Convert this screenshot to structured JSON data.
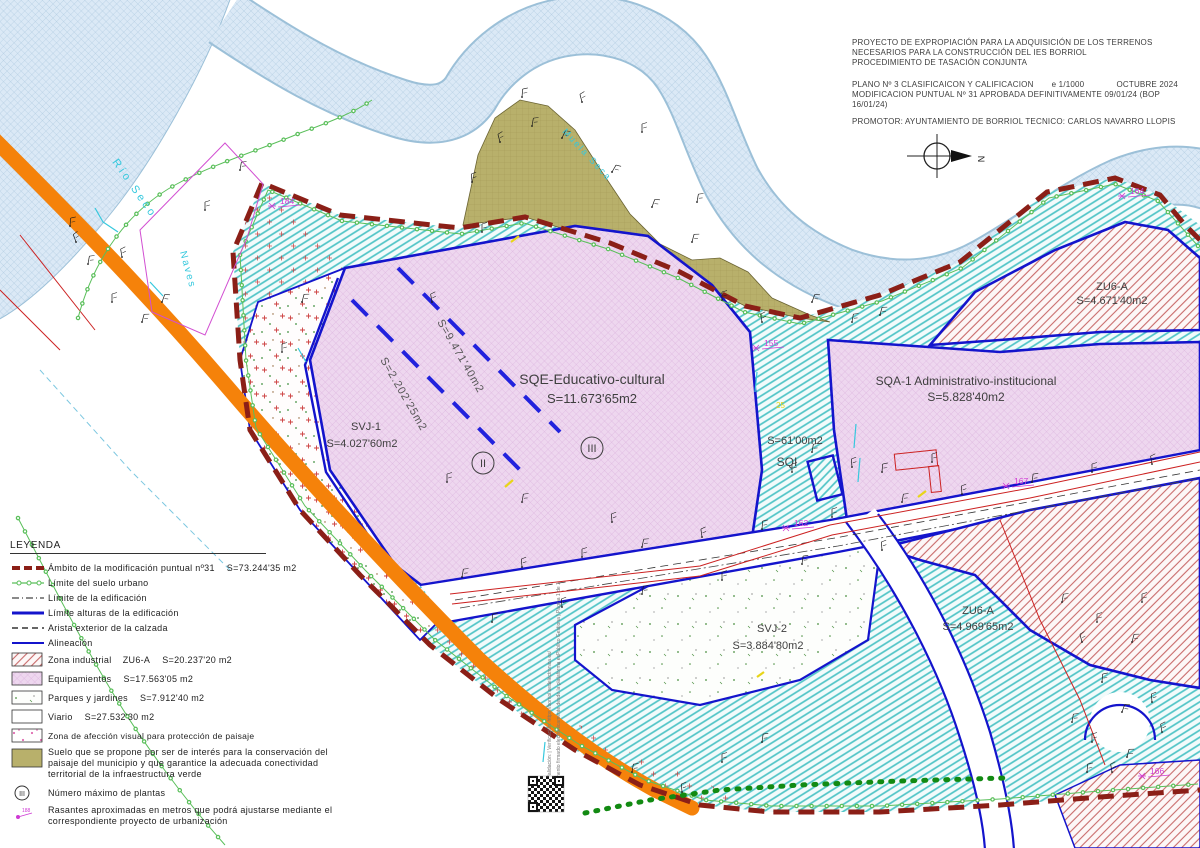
{
  "title_block": {
    "line1": "PROYECTO DE EXPROPIACIÓN PARA LA ADQUISICIÓN DE LOS TERRENOS",
    "line2": "NECESARIOS PARA LA CONSTRUCCIÓN DEL IES BORRIOL",
    "line3": "PROCEDIMIENTO DE TASACIÓN CONJUNTA",
    "plan": "PLANO Nº 3 CLASIFICAICON Y CALIFICACION",
    "scale": "e 1/1000",
    "date": "OCTUBRE 2024",
    "modification": "MODIFICACION PUNTUAL Nº 31 APROBADA DEFINITIVAMENTE 09/01/24 (BOP 16/01/24)",
    "promoter": "PROMOTOR: AYUNTAMIENTO DE BORRIOL  TECNICO: CARLOS NAVARRO LLOPIS"
  },
  "north_label": "N",
  "legend": {
    "title": "LEYENDA",
    "plantas_icon_text": "III",
    "rasantes_icon_text": "188",
    "items": [
      {
        "label": "Ámbito de la modificación puntual nº31",
        "area": "S=73.244'35 m2"
      },
      {
        "label": "Límite del suelo urbano",
        "area": ""
      },
      {
        "label": "Límite de la edificación",
        "area": ""
      },
      {
        "label": "Límite alturas de la edificación",
        "area": ""
      },
      {
        "label": "Arista exterior de la calzada",
        "area": ""
      },
      {
        "label": "Alineación",
        "area": ""
      },
      {
        "label": "Zona industrial    ZU6-A",
        "area": "S=20.237'20 m2"
      },
      {
        "label": "Equipamientos",
        "area": "S=17.563'05 m2"
      },
      {
        "label": "Parques y jardines",
        "area": "S=7.912'40 m2"
      },
      {
        "label": "Viario",
        "area": "S=27.532'30 m2"
      },
      {
        "label": "Zona de afección visual para protección de paisaje",
        "area": ""
      },
      {
        "label": "Suelo que se propone por ser de interés para la conservación del paisaje del municipio y que garantice la adecuada conectividad territorial de la infraestructura verde",
        "area": ""
      },
      {
        "label": "Número máximo de plantas",
        "area": ""
      },
      {
        "label": "Rasantes aproximadas en metros que podrá ajustarse mediante el correspondiente proyecto de urbanización",
        "area": ""
      }
    ]
  },
  "zones": {
    "sqe": {
      "name": "SQE-Educativo-cultural",
      "area": "S=11.673'65m2"
    },
    "sqa": {
      "name": "SQA-1  Administrativo-institucional",
      "area": "S=5.828'40m2"
    },
    "zu6a_north": {
      "name": "ZU6-A",
      "area": "S=4.671'40m2"
    },
    "zu6a_south": {
      "name": "ZU6-A",
      "area": "S=4.969'65m2"
    },
    "svj1": {
      "name": "SVJ-1",
      "area": "S=4.027'60m2"
    },
    "svj2": {
      "name": "SVJ-2",
      "area": "S=3.884'80m2"
    },
    "sqi": {
      "name": "SQI",
      "area": "S=61'00m2"
    },
    "sqe_sub1": "S=9.471'40m2",
    "sqe_sub2": "S=2.202'25m2"
  },
  "floors": {
    "two": "II",
    "three": "III"
  },
  "base_labels": {
    "river": "Río Seco",
    "industrial_sheds": "Naves",
    "hill": "Muela Seca"
  },
  "grade_points": {
    "p184": "184",
    "p164": "164",
    "p155": "155",
    "p162": "162",
    "p167": "167",
    "p166": "166",
    "p25": "25"
  },
  "stamp": {
    "line1": "Cód. Validación: | Verificación: https://borriol.sedelectronica.es/",
    "line2": "Documento firmado electrónicamente desde la plataforma esPublico Gestiona | Página 1 de 1"
  },
  "colors": {
    "ambito_dark_red": "#8b1f17",
    "urban_limit_green": "#5abf5a",
    "blue_line": "#1414cc",
    "road_orange": "#f5820a",
    "teal_hatch": "#4fc4c6",
    "equipment_pink": "#eed7ef",
    "industrial_red": "#c96b6b",
    "parks_green": "#4a8f3f",
    "conservation_olive": "#b8b06b",
    "point_label_magenta": "#cf3ad4",
    "base_cyan": "#35c8dd",
    "river_blue": "#dbe9f6"
  }
}
